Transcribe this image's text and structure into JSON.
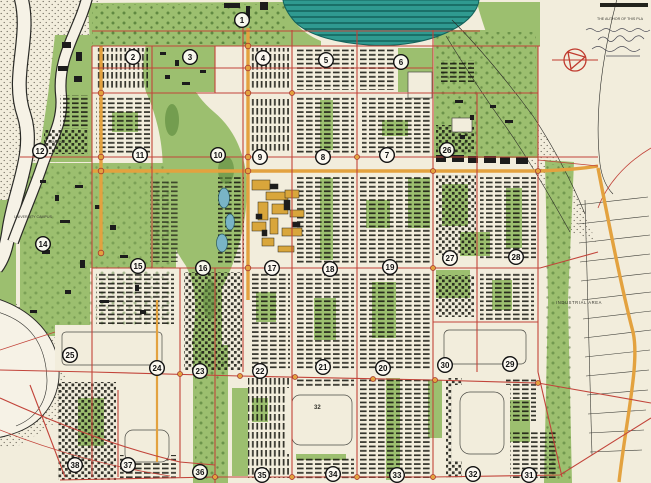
{
  "map": {
    "title": "planned city master plan map",
    "colors": {
      "paper": "#f2eddc",
      "green": "#9cbf6f",
      "green_dark": "#5e8a3e",
      "lake": "#2f9a90",
      "lake_line": "#14625b",
      "pond": "#79b4c6",
      "road_red": "#c2443a",
      "road_orange": "#e3a23f",
      "ink": "#1c1c1c",
      "yellow_block": "#d9a63b",
      "symbol_red": "#c03a2e"
    },
    "labels": {
      "university_campus": "UNIVERSITY CAMPUS",
      "industrial_area": "INDUSTRIAL AREA",
      "pumping": "PUMPING",
      "block_32": "32",
      "author_note": "THE AUTHOR OF THIS PLA"
    },
    "sectors": [
      {
        "n": "1",
        "x": 242,
        "y": 20
      },
      {
        "n": "2",
        "x": 133,
        "y": 57
      },
      {
        "n": "3",
        "x": 190,
        "y": 57
      },
      {
        "n": "4",
        "x": 263,
        "y": 58
      },
      {
        "n": "5",
        "x": 326,
        "y": 60
      },
      {
        "n": "6",
        "x": 401,
        "y": 62
      },
      {
        "n": "12",
        "x": 40,
        "y": 151
      },
      {
        "n": "11",
        "x": 140,
        "y": 155
      },
      {
        "n": "10",
        "x": 218,
        "y": 155
      },
      {
        "n": "9",
        "x": 260,
        "y": 157
      },
      {
        "n": "8",
        "x": 323,
        "y": 157
      },
      {
        "n": "7",
        "x": 387,
        "y": 155
      },
      {
        "n": "26",
        "x": 447,
        "y": 150
      },
      {
        "n": "14",
        "x": 43,
        "y": 244
      },
      {
        "n": "15",
        "x": 138,
        "y": 266
      },
      {
        "n": "16",
        "x": 203,
        "y": 268
      },
      {
        "n": "17",
        "x": 272,
        "y": 268
      },
      {
        "n": "18",
        "x": 330,
        "y": 269
      },
      {
        "n": "19",
        "x": 390,
        "y": 267
      },
      {
        "n": "27",
        "x": 450,
        "y": 258
      },
      {
        "n": "28",
        "x": 516,
        "y": 257
      },
      {
        "n": "25",
        "x": 70,
        "y": 355
      },
      {
        "n": "24",
        "x": 157,
        "y": 368
      },
      {
        "n": "23",
        "x": 200,
        "y": 371
      },
      {
        "n": "22",
        "x": 260,
        "y": 371
      },
      {
        "n": "21",
        "x": 323,
        "y": 367
      },
      {
        "n": "20",
        "x": 383,
        "y": 368
      },
      {
        "n": "30",
        "x": 445,
        "y": 365
      },
      {
        "n": "29",
        "x": 510,
        "y": 364
      },
      {
        "n": "38",
        "x": 75,
        "y": 465
      },
      {
        "n": "37",
        "x": 128,
        "y": 465
      },
      {
        "n": "36",
        "x": 200,
        "y": 472
      },
      {
        "n": "35",
        "x": 262,
        "y": 475
      },
      {
        "n": "34",
        "x": 333,
        "y": 474
      },
      {
        "n": "33",
        "x": 397,
        "y": 475
      },
      {
        "n": "32",
        "x": 473,
        "y": 474
      },
      {
        "n": "31",
        "x": 529,
        "y": 475
      }
    ]
  }
}
